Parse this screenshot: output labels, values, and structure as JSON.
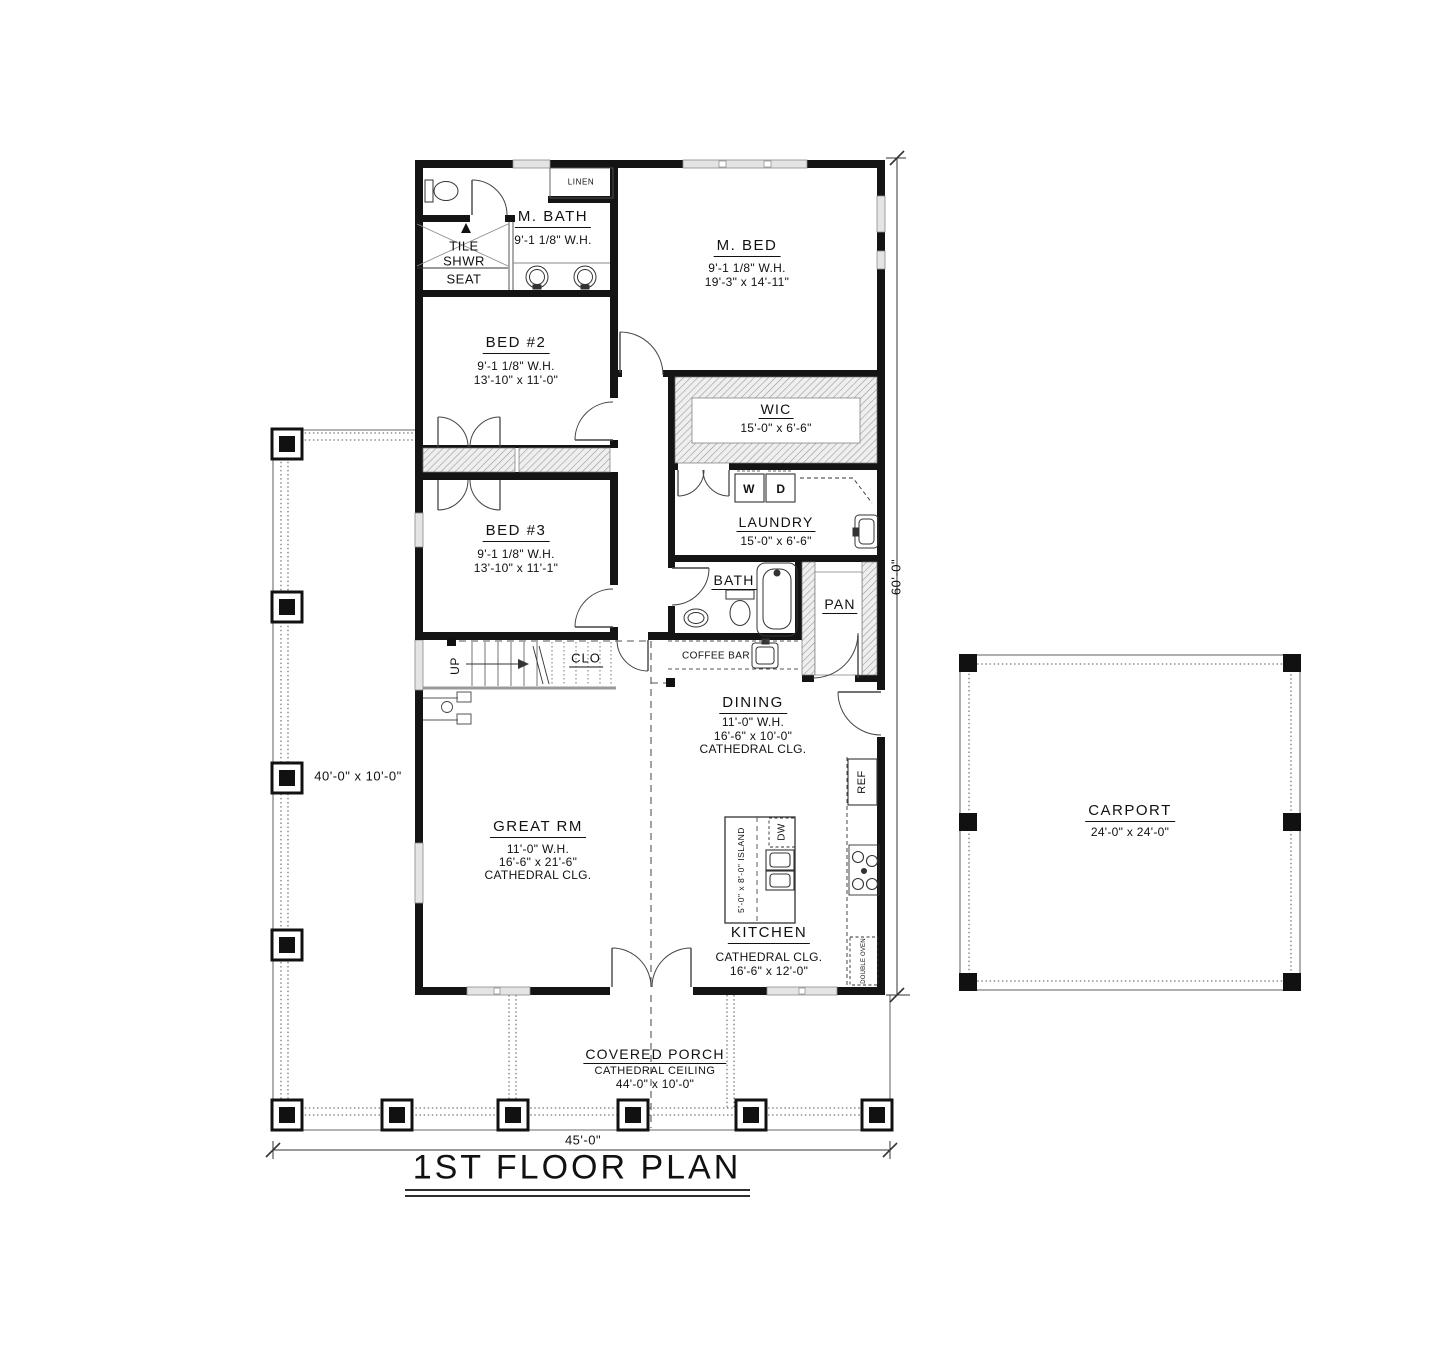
{
  "title": {
    "text": "1ST FLOOR PLAN"
  },
  "dimensions": {
    "bottom_width": "45'-0\"",
    "right_height": "60'-0\"",
    "left_porch_size": "40'-0\" x 10'-0\""
  },
  "rooms": {
    "m_bath": {
      "name": "M. BATH",
      "wall_height": "9'-1 1/8\" W.H."
    },
    "m_bed": {
      "name": "M. BED",
      "wall_height": "9'-1 1/8\" W.H.",
      "size": "19'-3\" x 14'-11\""
    },
    "bed2": {
      "name": "BED #2",
      "wall_height": "9'-1 1/8\" W.H.",
      "size": "13'-10\" x 11'-0\""
    },
    "bed3": {
      "name": "BED #3",
      "wall_height": "9'-1 1/8\" W.H.",
      "size": "13'-10\" x 11'-1\""
    },
    "wic": {
      "name": "WIC",
      "size": "15'-0\" x 6'-6\""
    },
    "laundry": {
      "name": "LAUNDRY",
      "size": "15'-0\" x 6'-6\""
    },
    "bath": {
      "name": "BATH"
    },
    "pantry": {
      "name": "PAN"
    },
    "closet": {
      "name": "CLO"
    },
    "dining": {
      "name": "DINING",
      "wall_height": "11'-0\" W.H.",
      "size": "16'-6\" x 10'-0\"",
      "ceiling": "CATHEDRAL CLG."
    },
    "great_rm": {
      "name": "GREAT RM",
      "wall_height": "11'-0\" W.H.",
      "size": "16'-6\" x 21'-6\"",
      "ceiling": "CATHEDRAL CLG."
    },
    "kitchen": {
      "name": "KITCHEN",
      "ceiling": "CATHEDRAL CLG.",
      "size": "16'-6\" x 12'-0\""
    },
    "covered_porch": {
      "name": "COVERED PORCH",
      "ceiling": "CATHEDRAL CEILING",
      "size": "44'-0\" x 10'-0\""
    },
    "carport": {
      "name": "CARPORT",
      "size": "24'-0\" x 24'-0\""
    }
  },
  "fixtures": {
    "linen": "LINEN",
    "tile": "TILE",
    "shwr": "SHWR",
    "seat": "SEAT",
    "washer": "W",
    "dryer": "D",
    "coffee_bar": "COFFEE BAR",
    "fridge": "REF",
    "dishwasher": "DW",
    "island": "5'-0\" x 8'-0\" ISLAND",
    "double_oven": "DOUBLE OVEN",
    "stairs_up": "UP"
  }
}
